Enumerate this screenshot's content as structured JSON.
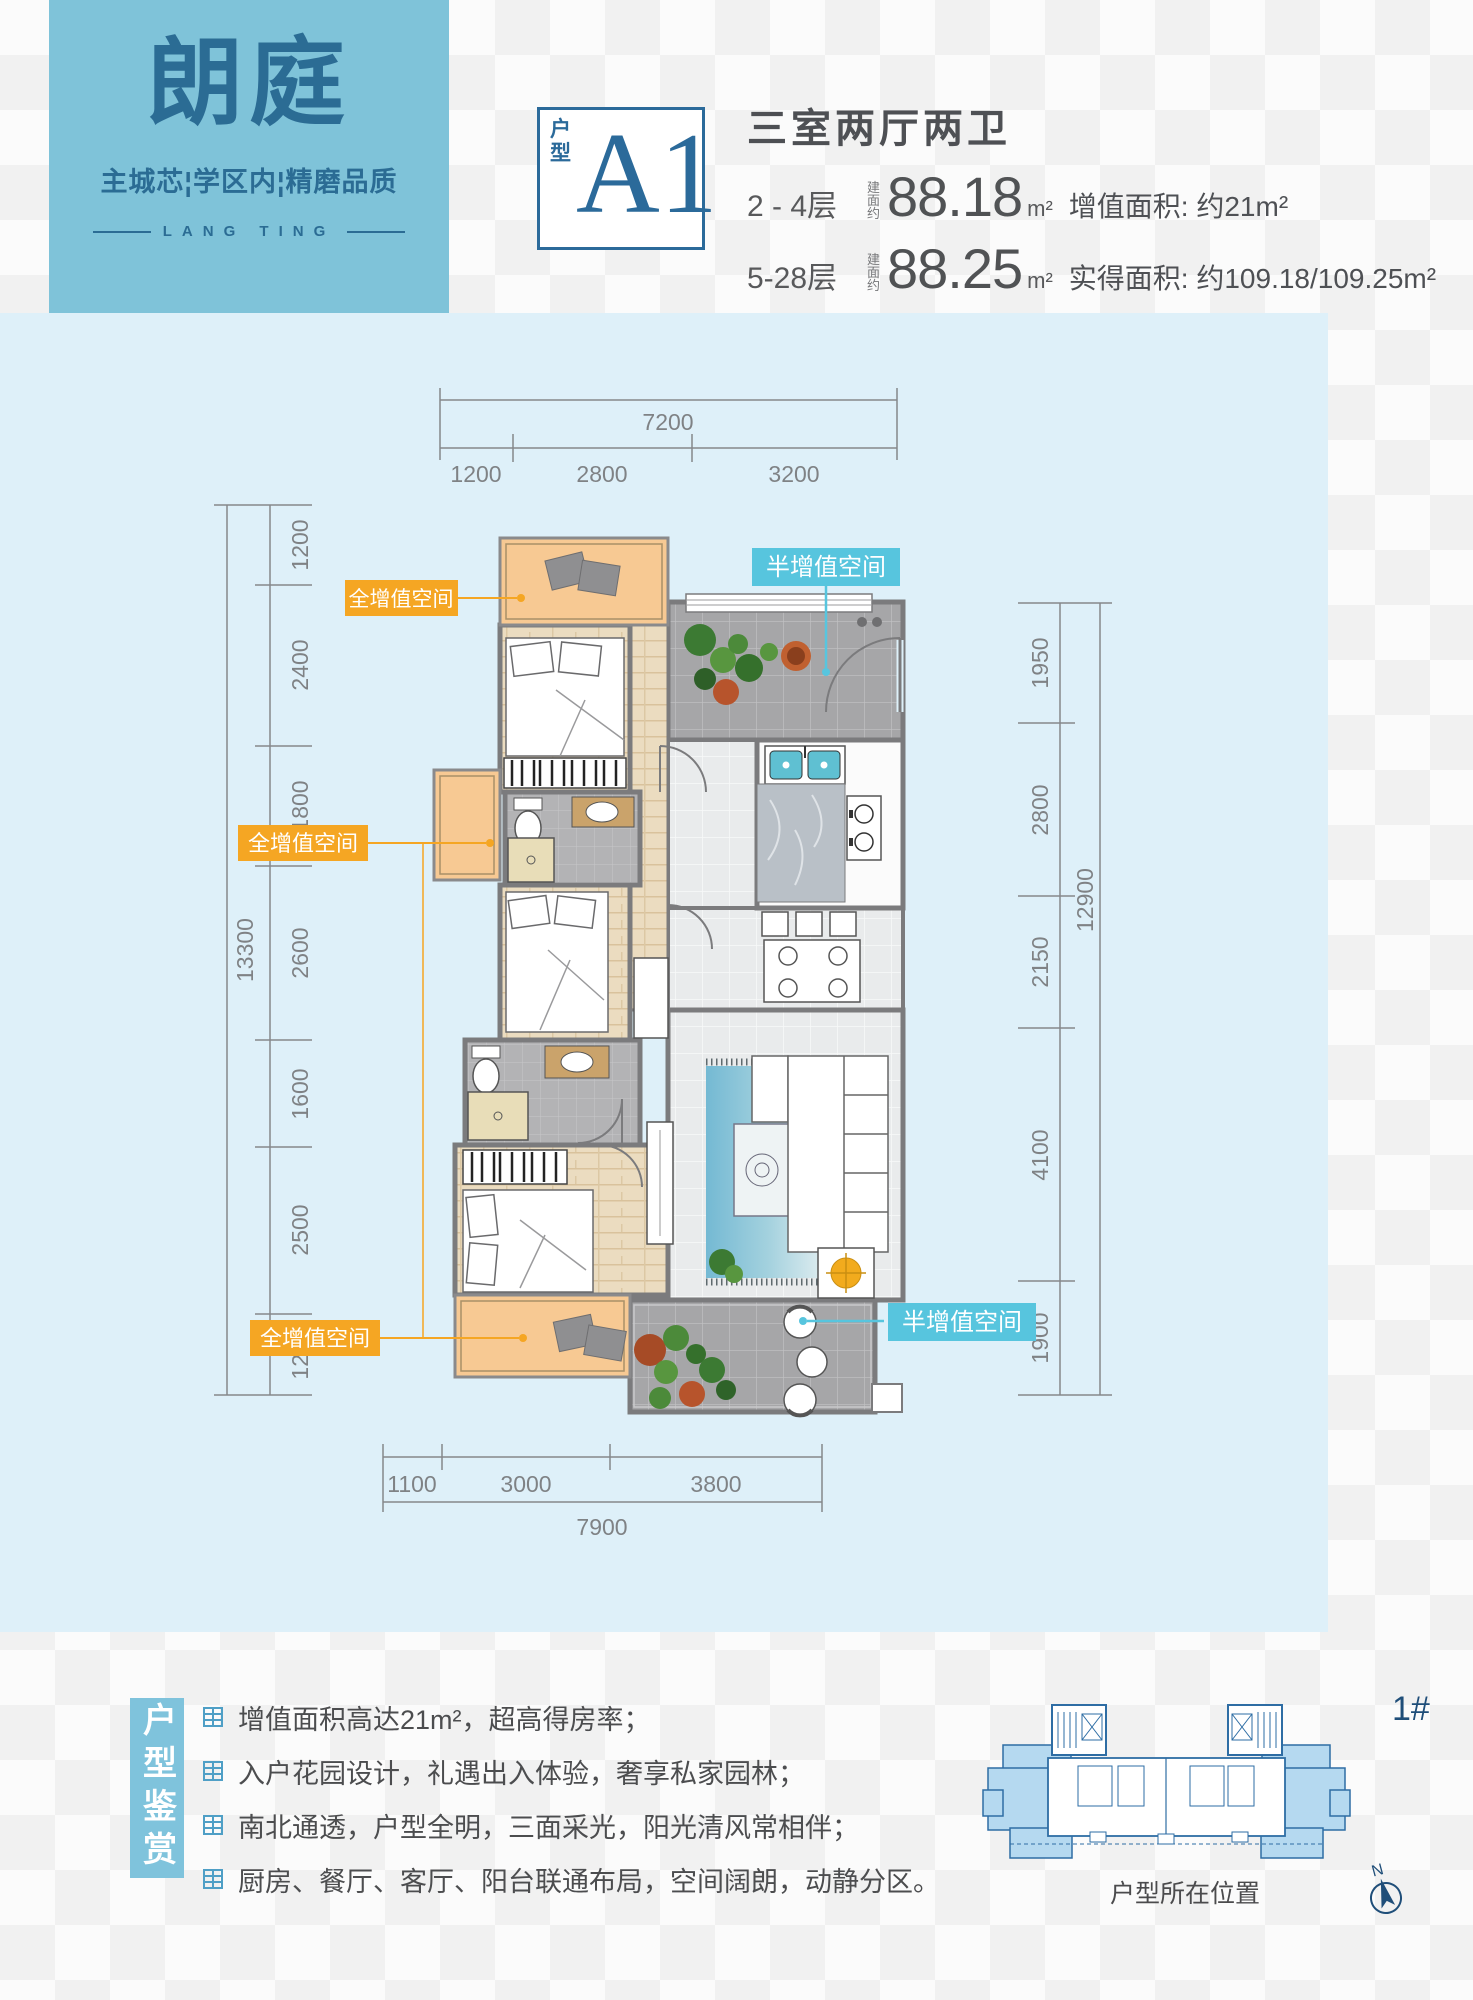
{
  "brand": {
    "name": "朗庭",
    "tagline": "主城芯¦学区内¦精磨品质",
    "latin": "LANG TING"
  },
  "header": {
    "unit_label": "户型",
    "unit_code": "A1",
    "layout_title": "三室两厅两卫",
    "rows": [
      {
        "floors": "2 - 4层",
        "area_prefix": "建面约",
        "area": "88.18",
        "unit": "m²",
        "note": "增值面积: 约21m²"
      },
      {
        "floors": "5-28层",
        "area_prefix": "建面约",
        "area": "88.25",
        "unit": "m²",
        "note": "实得面积: 约109.18/109.25m²"
      }
    ]
  },
  "plan": {
    "labels": {
      "full1": "全增值空间",
      "full2": "全增值空间",
      "full3": "全增值空间",
      "half1": "半增值空间",
      "half2": "半增值空间"
    },
    "dims": {
      "top": {
        "total": "7200",
        "segments": [
          "1200",
          "2800",
          "3200"
        ]
      },
      "bottom": {
        "total": "7900",
        "segments": [
          "1100",
          "3000",
          "3800"
        ]
      },
      "left": {
        "total": "13300",
        "segments": [
          "1200",
          "2400",
          "1800",
          "2600",
          "1600",
          "2500",
          "1200"
        ]
      },
      "right": {
        "total": "12900",
        "segments": [
          "1950",
          "2800",
          "2150",
          "4100",
          "1900"
        ]
      }
    }
  },
  "appreciation": {
    "title": "户型鉴赏",
    "bullets": [
      "增值面积高达21m²，超高得房率；",
      "入户花园设计，礼遇出入体验，奢享私家园林；",
      "南北通透，户型全明，三面采光，阳光清风常相伴；",
      "厨房、餐厅、客厅、阳台联通布局，空间阔朗，动静分区。"
    ]
  },
  "keyplan": {
    "building_no": "1#",
    "caption": "户型所在位置",
    "compass": "N"
  },
  "colors": {
    "teal": "#7fc3d9",
    "blue_dark": "#2b6a9a",
    "orange": "#f5a623",
    "cyan": "#57c5de",
    "panel": "#def0f9"
  }
}
